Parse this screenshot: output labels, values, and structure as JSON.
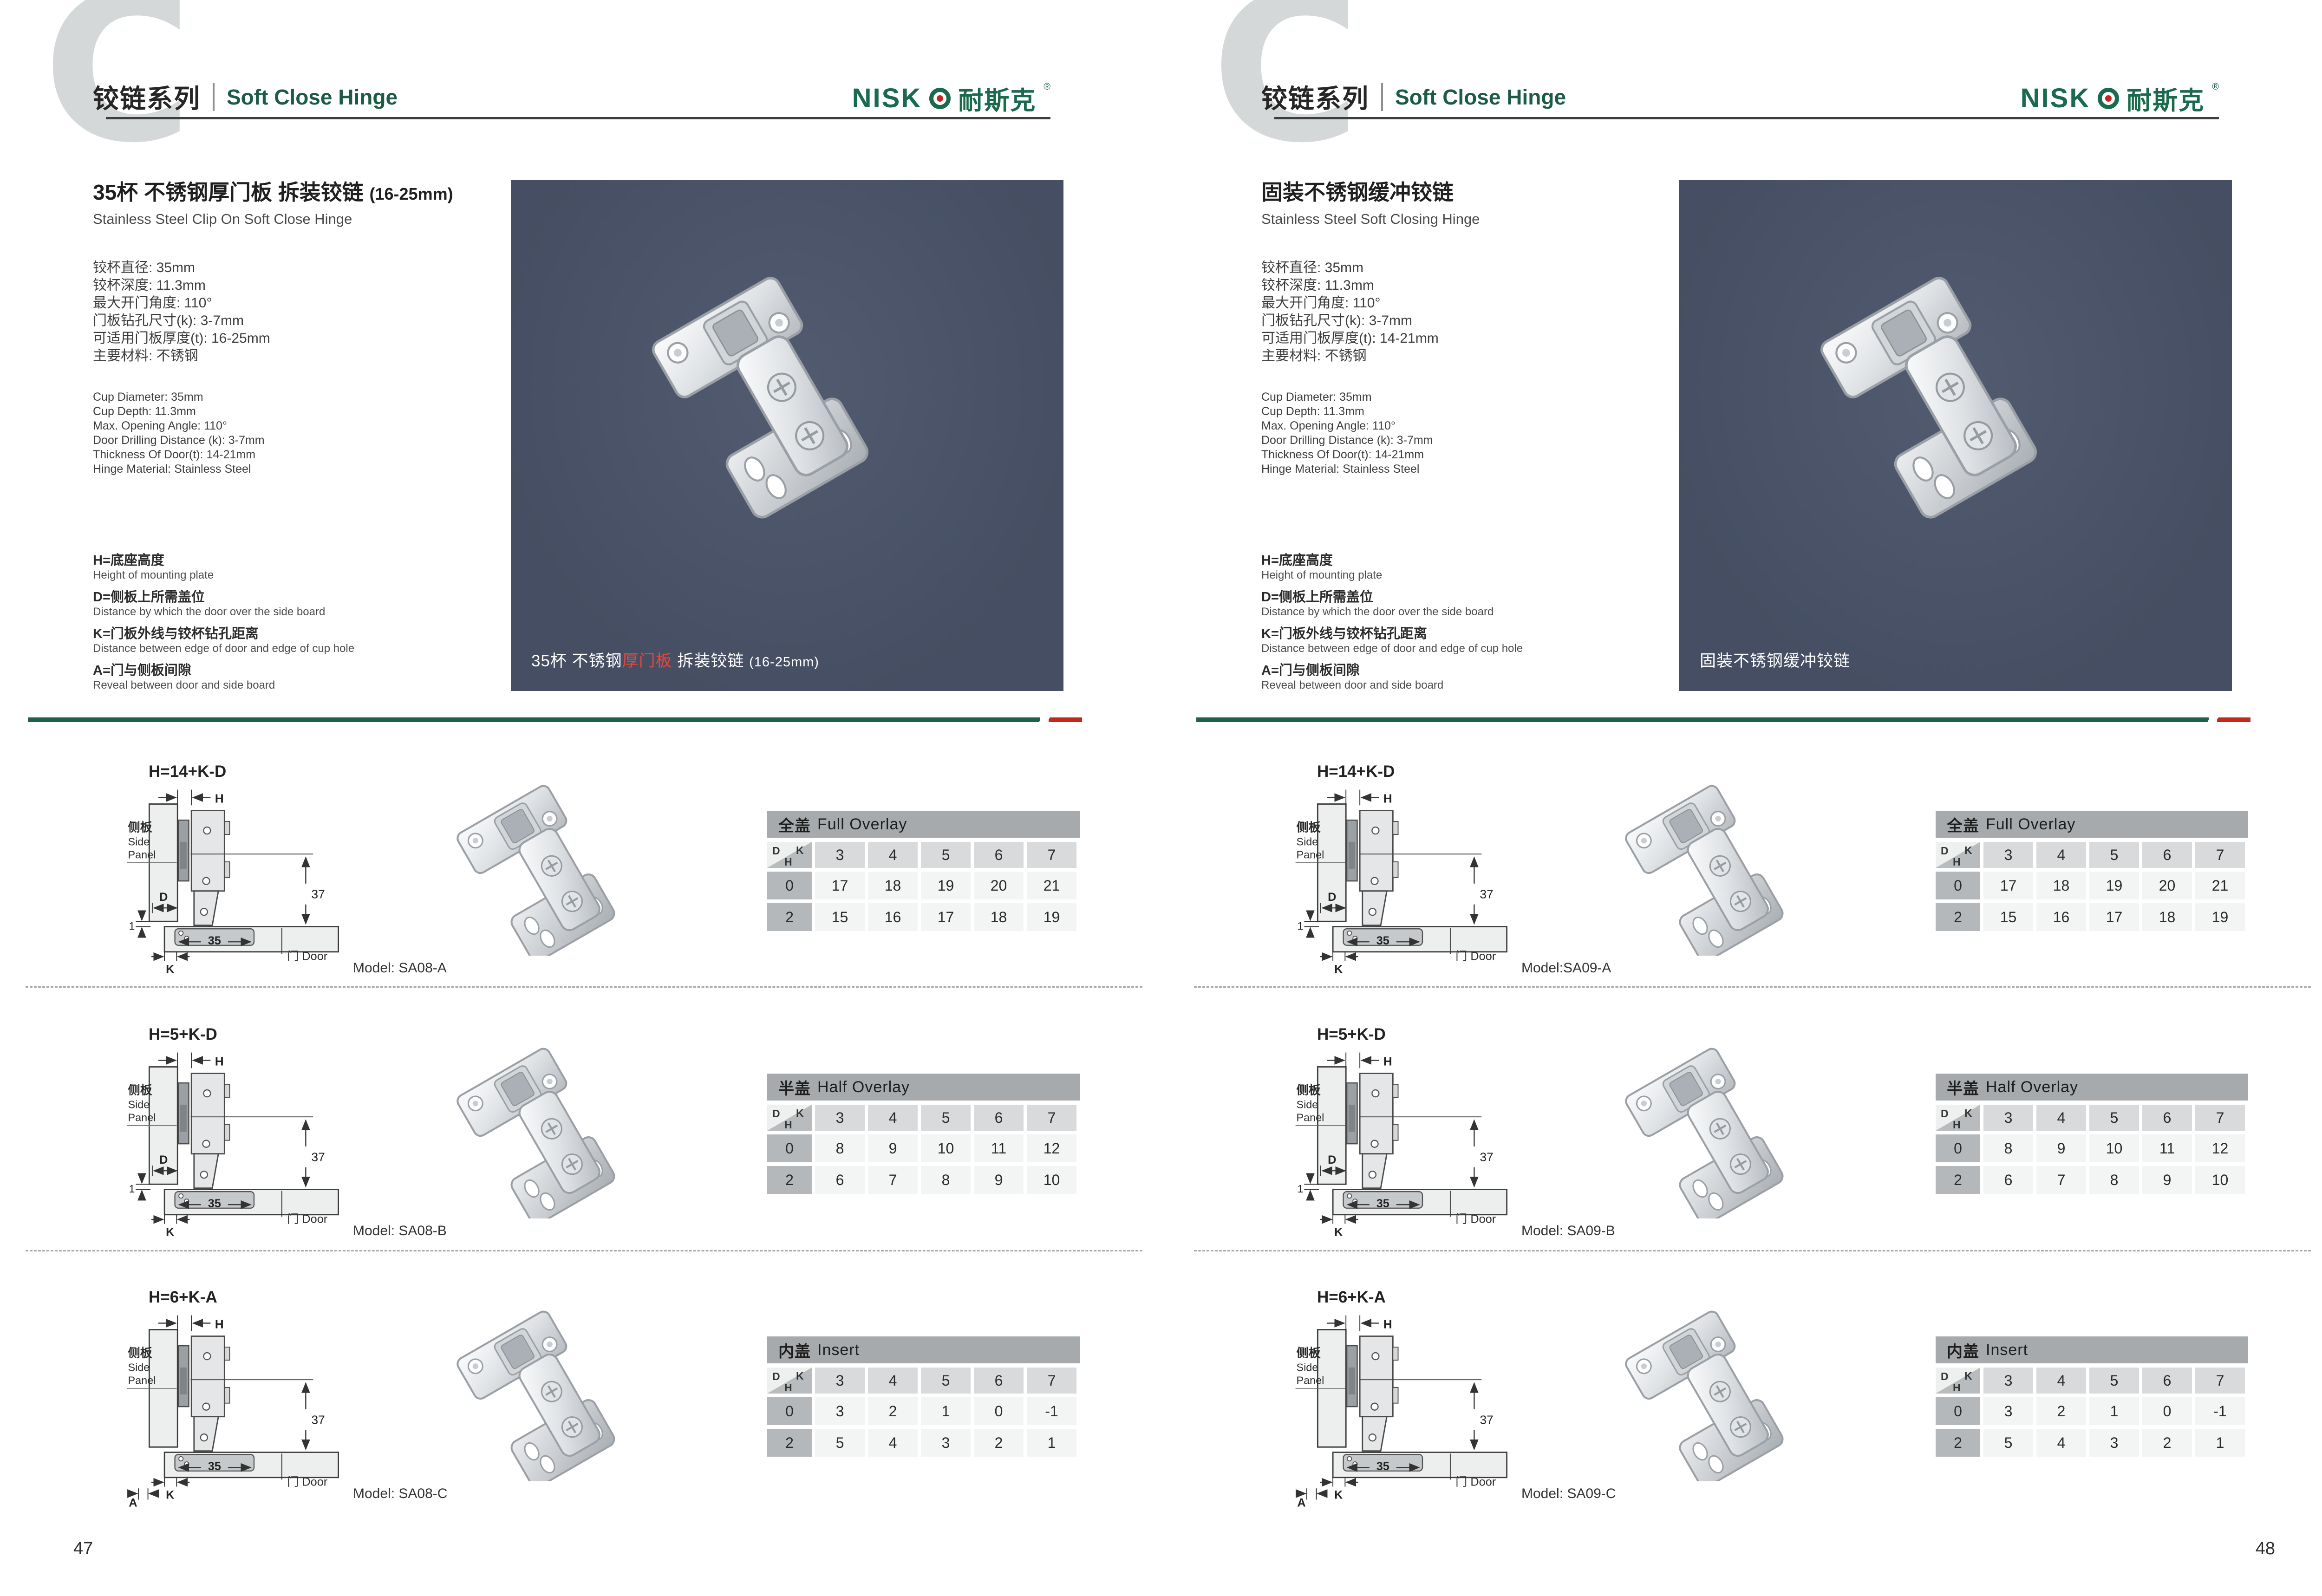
{
  "brand": {
    "logo_en": "NISK",
    "logo_cn": "耐斯克",
    "logo_reg": "®",
    "series_cn": "铰链系列",
    "series_en": "Soft Close Hinge",
    "accent_green": "#1a6a4d",
    "accent_red": "#c1291f"
  },
  "diagram_labels": {
    "side_panel_cn": "侧板",
    "side_panel_en1": "Side",
    "side_panel_en2": "Panel",
    "door": "门 Door",
    "h": "H",
    "d": "D",
    "k": "K",
    "a": "A",
    "dim37": "37",
    "dim35": "35",
    "dim1": "1"
  },
  "pages": [
    {
      "page_number": "47",
      "title_cn": "35杯 不锈钢厚门板 拆装铰链 ",
      "title_size": "(16-25mm)",
      "title_en": "Stainless Steel Clip On Soft Close Hinge",
      "specs_cn": [
        "铰杯直径: 35mm",
        "铰杯深度: 11.3mm",
        "最大开门角度: 110°",
        "门板钻孔尺寸(k): 3-7mm",
        "可适用门板厚度(t): 16-25mm",
        "主要材料: 不锈钢"
      ],
      "specs_en": [
        "Cup Diameter: 35mm",
        "Cup Depth: 11.3mm",
        "Max. Opening Angle: 110°",
        "Door Drilling Distance (k): 3-7mm",
        "Thickness Of Door(t): 14-21mm",
        "Hinge Material: Stainless Steel"
      ],
      "legend": [
        {
          "cn": "H=底座高度",
          "en": "Height of mounting plate"
        },
        {
          "cn": "D=侧板上所需盖位",
          "en": "Distance by which the door over the side board"
        },
        {
          "cn": "K=门板外线与铰杯钻孔距离",
          "en": "Distance between edge of door and edge of cup hole"
        },
        {
          "cn": "A=门与侧板间隙",
          "en": "Reveal between door and side board"
        }
      ],
      "hero": {
        "pre": "35杯 不锈钢",
        "red": "厚门板",
        "post": " 拆装铰链 ",
        "size": "(16-25mm)"
      },
      "rows": [
        {
          "formula": "H=14+K-D",
          "variant": "d",
          "model": "Model: SA08-A",
          "table": {
            "title_cn": "全盖",
            "title_en": "Full Overlay",
            "cols": [
              "3",
              "4",
              "5",
              "6",
              "7"
            ],
            "rows": [
              {
                "label": "0",
                "values": [
                  "17",
                  "18",
                  "19",
                  "20",
                  "21"
                ]
              },
              {
                "label": "2",
                "values": [
                  "15",
                  "16",
                  "17",
                  "18",
                  "19"
                ]
              }
            ]
          }
        },
        {
          "formula": "H=5+K-D",
          "variant": "d",
          "model": "Model: SA08-B",
          "table": {
            "title_cn": "半盖",
            "title_en": "Half Overlay",
            "cols": [
              "3",
              "4",
              "5",
              "6",
              "7"
            ],
            "rows": [
              {
                "label": "0",
                "values": [
                  "8",
                  "9",
                  "10",
                  "11",
                  "12"
                ]
              },
              {
                "label": "2",
                "values": [
                  "6",
                  "7",
                  "8",
                  "9",
                  "10"
                ]
              }
            ]
          }
        },
        {
          "formula": "H=6+K-A",
          "variant": "a",
          "model": "Model: SA08-C",
          "table": {
            "title_cn": "内盖",
            "title_en": "Insert",
            "cols": [
              "3",
              "4",
              "5",
              "6",
              "7"
            ],
            "rows": [
              {
                "label": "0",
                "values": [
                  "3",
                  "2",
                  "1",
                  "0",
                  "-1"
                ]
              },
              {
                "label": "2",
                "values": [
                  "5",
                  "4",
                  "3",
                  "2",
                  "1"
                ]
              }
            ]
          }
        }
      ]
    },
    {
      "page_number": "48",
      "title_cn": "固装不锈钢缓冲铰链",
      "title_size": "",
      "title_en": "Stainless Steel Soft Closing Hinge",
      "specs_cn": [
        "铰杯直径: 35mm",
        "铰杯深度: 11.3mm",
        "最大开门角度: 110°",
        "门板钻孔尺寸(k): 3-7mm",
        "可适用门板厚度(t): 14-21mm",
        "主要材料: 不锈钢"
      ],
      "specs_en": [
        "Cup Diameter: 35mm",
        "Cup Depth: 11.3mm",
        "Max. Opening Angle: 110°",
        "Door Drilling Distance (k): 3-7mm",
        "Thickness Of Door(t): 14-21mm",
        "Hinge Material: Stainless Steel"
      ],
      "legend": [
        {
          "cn": "H=底座高度",
          "en": "Height of mounting plate"
        },
        {
          "cn": "D=侧板上所需盖位",
          "en": "Distance by which the door over the side board"
        },
        {
          "cn": "K=门板外线与铰杯钻孔距离",
          "en": "Distance between edge of door and edge of cup hole"
        },
        {
          "cn": "A=门与侧板间隙",
          "en": "Reveal between door and side board"
        }
      ],
      "hero": {
        "pre": "固装不锈钢缓冲铰链",
        "red": "",
        "post": "",
        "size": ""
      },
      "rows": [
        {
          "formula": "H=14+K-D",
          "variant": "d",
          "model": "Model:SA09-A",
          "table": {
            "title_cn": "全盖",
            "title_en": "Full Overlay",
            "cols": [
              "3",
              "4",
              "5",
              "6",
              "7"
            ],
            "rows": [
              {
                "label": "0",
                "values": [
                  "17",
                  "18",
                  "19",
                  "20",
                  "21"
                ]
              },
              {
                "label": "2",
                "values": [
                  "15",
                  "16",
                  "17",
                  "18",
                  "19"
                ]
              }
            ]
          }
        },
        {
          "formula": "H=5+K-D",
          "variant": "d",
          "model": "Model: SA09-B",
          "table": {
            "title_cn": "半盖",
            "title_en": "Half Overlay",
            "cols": [
              "3",
              "4",
              "5",
              "6",
              "7"
            ],
            "rows": [
              {
                "label": "0",
                "values": [
                  "8",
                  "9",
                  "10",
                  "11",
                  "12"
                ]
              },
              {
                "label": "2",
                "values": [
                  "6",
                  "7",
                  "8",
                  "9",
                  "10"
                ]
              }
            ]
          }
        },
        {
          "formula": "H=6+K-A",
          "variant": "a",
          "model": "Model: SA09-C",
          "table": {
            "title_cn": "内盖",
            "title_en": "Insert",
            "cols": [
              "3",
              "4",
              "5",
              "6",
              "7"
            ],
            "rows": [
              {
                "label": "0",
                "values": [
                  "3",
                  "2",
                  "1",
                  "0",
                  "-1"
                ]
              },
              {
                "label": "2",
                "values": [
                  "5",
                  "4",
                  "3",
                  "2",
                  "1"
                ]
              }
            ]
          }
        }
      ]
    }
  ]
}
